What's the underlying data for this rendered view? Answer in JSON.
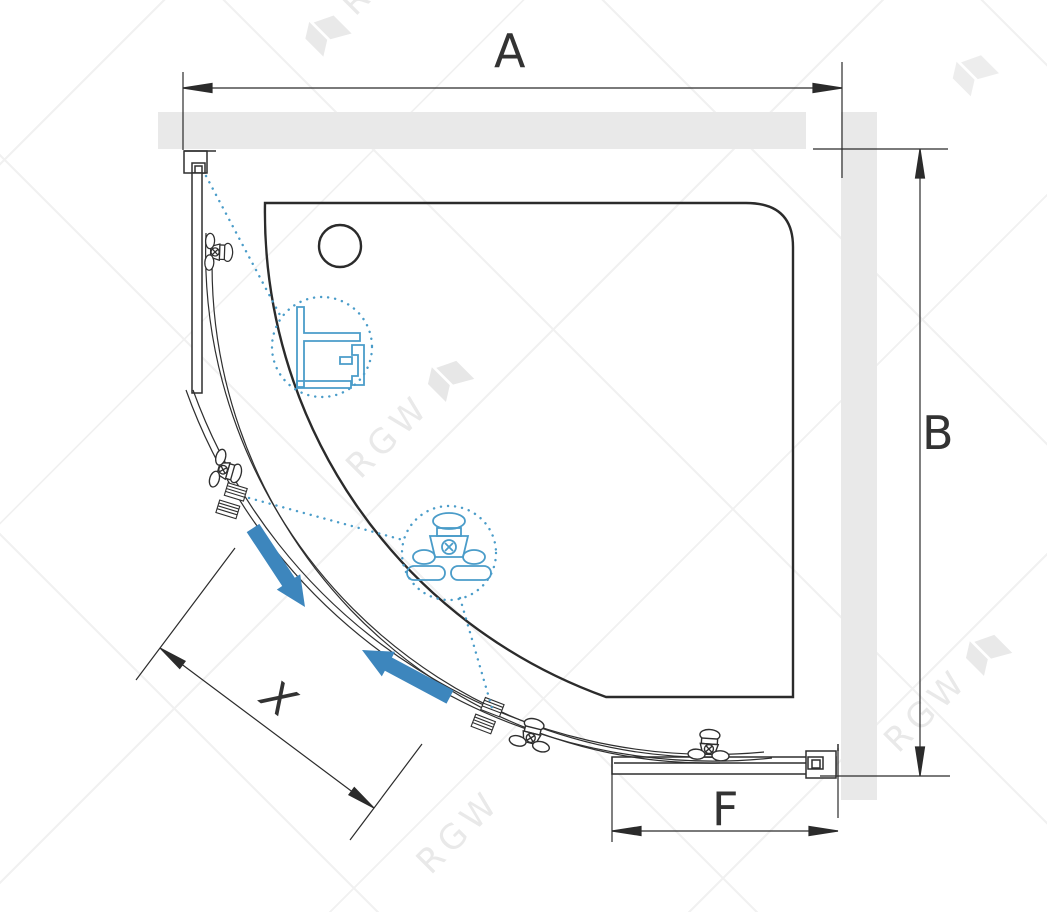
{
  "diagram": {
    "title": "quadrant-shower-enclosure-top-view",
    "dimension_labels": {
      "width": "A",
      "depth": "B",
      "fixed_panel": "F",
      "door_opening": "X"
    },
    "watermark": {
      "text": "RGW"
    },
    "icons": {
      "flag_logo": "rgw-flag-icon",
      "roller": "door-roller-icon",
      "handle": "door-handle-icon",
      "detail_profile": "wall-profile-detail-icon",
      "detail_roller": "roller-detail-icon"
    },
    "colors": {
      "accent_blue": "#3d86bd",
      "detail_blue": "#4a9cc9",
      "wall_gray": "#e9e9e9",
      "line_dark": "#2b2b2b",
      "watermark_gray": "#e9e9e9"
    }
  }
}
